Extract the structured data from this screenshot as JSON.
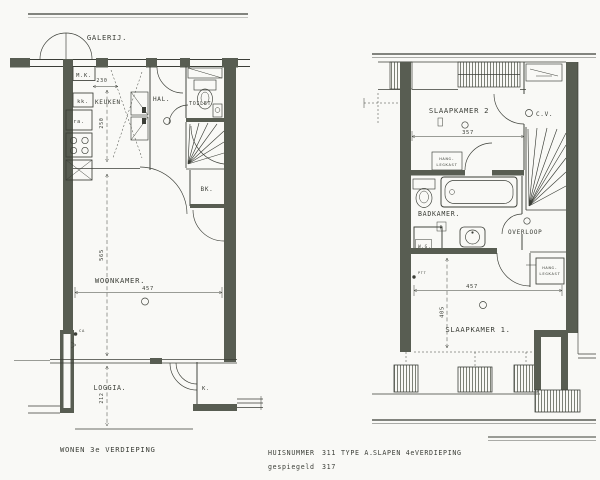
{
  "style": {
    "paper_color": "#f9f9f6",
    "ink_color": "#3b3e37",
    "wall_color": "#585d52",
    "hatch_color": "#6f7368"
  },
  "plan_left": {
    "rooms": {
      "galerij": "GALERIJ.",
      "mk": "M.K.",
      "kk": "kk.",
      "keuken": "KEUKEN",
      "hal": "HAL.",
      "toilet": "TOILET",
      "ra": "ra.",
      "bk": "BK.",
      "woonkamer": "WOONKAMER.",
      "loggia": "LOGGIA.",
      "kast": "K."
    },
    "dimensions": {
      "keuken_breedte": "230",
      "keuken_diepte": "250",
      "woonkamer_breedte": "457",
      "woonkamer_diepte": "565",
      "loggia_diepte": "212"
    },
    "annotations": {
      "ca": "CA"
    }
  },
  "plan_right": {
    "rooms": {
      "slaapkamer2": "SLAAPKAMER 2",
      "cv": "C.V.",
      "badkamer": "BADKAMER.",
      "radiator": "R",
      "wg": "W.G.",
      "overloop": "OVERLOOP",
      "slaapkamer1": "SLAAPKAMER 1.",
      "kast": {
        "line1": "HANG-",
        "line2": "LEGKAST"
      }
    },
    "dimensions": {
      "slaapkamer2_breedte": "357",
      "slaapkamer1_breedte": "457",
      "slaapkamer1_diepte": "405"
    },
    "annotations": {
      "ptt": "PTT"
    }
  },
  "footer": {
    "left_caption": "WONEN 3e VERDIEPING",
    "huisnummer_label": "HUISNUMMER",
    "huisnummer_value": "311",
    "type_value": "TYPE A.",
    "right_caption": "SLAPEN 4eVERDIEPING",
    "gespiegeld_label": "gespiegeld",
    "gespiegeld_value": "317"
  }
}
